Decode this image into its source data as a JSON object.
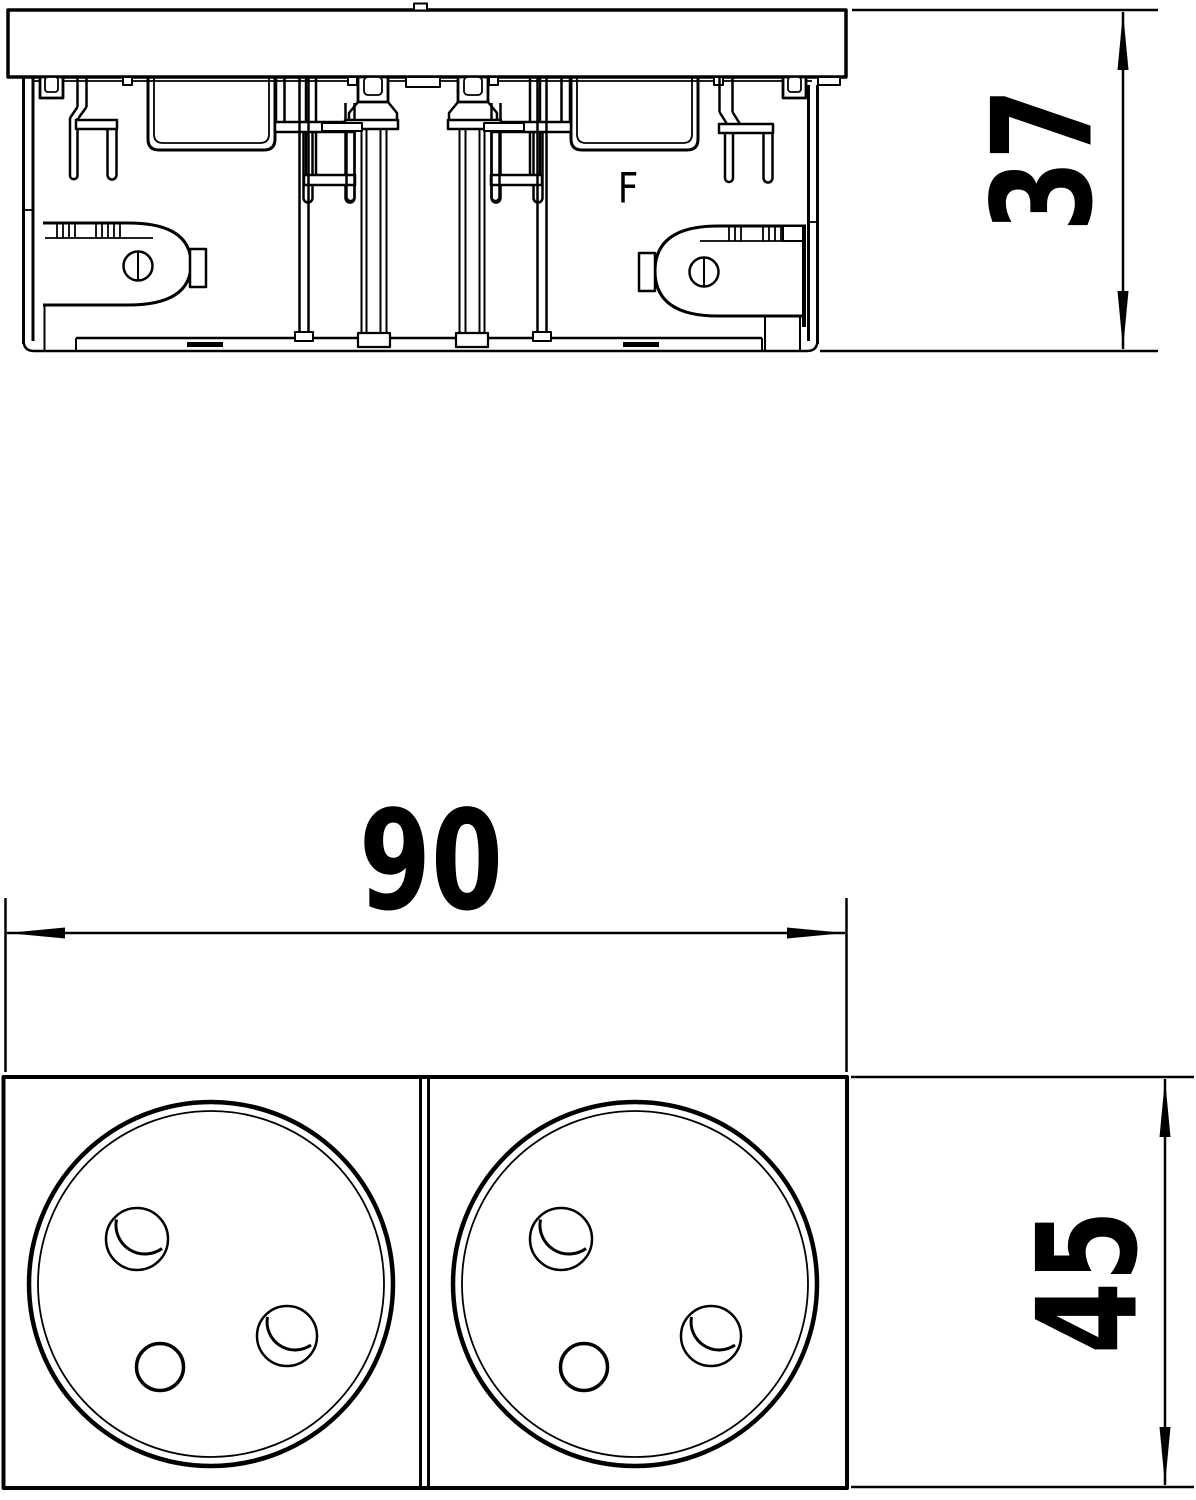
{
  "page": {
    "background_color": "#ffffff",
    "line_color": "#000000"
  },
  "side_view": {
    "marking": "F"
  },
  "dimensions": {
    "side_height": "37",
    "front_width": "90",
    "front_height": "45"
  }
}
